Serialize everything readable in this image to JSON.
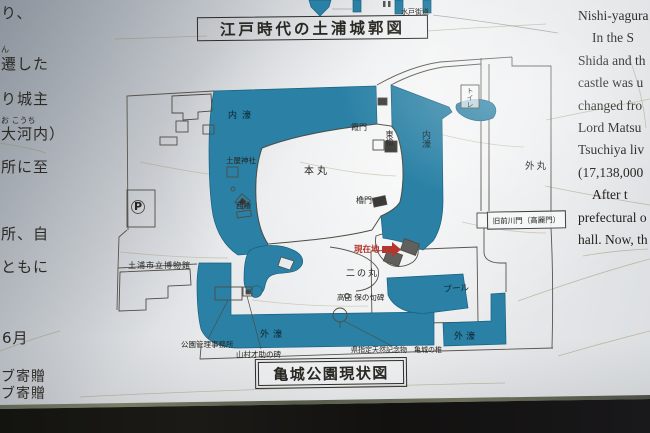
{
  "titles": {
    "edo_map": "江戸時代の土浦城郭図",
    "current_map": "亀城公園現状図"
  },
  "top_fragment": {
    "road_label": "水戸街道"
  },
  "left_text": {
    "lines": [
      {
        "text": "り、"
      },
      {
        "furigana": "ん",
        "text": "遷した"
      },
      {
        "text": "り城主"
      },
      {
        "furigana": "お こうち",
        "text": "大河内）"
      },
      {
        "text": "所に至"
      },
      {
        "text": "所、自"
      },
      {
        "text": "ともに"
      },
      {
        "text": "6月"
      },
      {
        "text": "ブ寄贈"
      },
      {
        "text": "ブ寄贈"
      }
    ]
  },
  "right_text": {
    "lines": [
      "Nishi-yagura",
      "In the S",
      "Shida and th",
      "castle was u",
      "changed fro",
      "Lord Matsu",
      "Tsuchiya liv",
      "(17,138,000",
      "After t",
      "prefectural o",
      "hall. Now, th"
    ]
  },
  "map": {
    "labels": {
      "inner_moat_top": "内濠",
      "inner_moat_right": "内濠",
      "outer_moat_left": "外濠",
      "outer_moat_right": "外濠",
      "honmaru": "本丸",
      "ninomaru": "二の丸",
      "sotomaru": "外丸",
      "tsuchiya_shrine": "土屋神社",
      "nishi_yagura": "西櫓",
      "higashi_yagura": "東櫓",
      "kasumi_gate": "霞門",
      "yagura_gate": "櫓門",
      "toilet": "トイレ",
      "old_maekawa_gate": "旧前川門（高麗門）",
      "current_location": "現在地",
      "takada_haiku_monument": "高田 保の句碑",
      "pool": "プール",
      "museum": "土浦市立博物館",
      "park_office": "公園管理事務所",
      "yamamura_monument": "山村才助の碑",
      "natural_monument": "県指定天然記念物　亀城の椎",
      "parking": "P"
    },
    "colors": {
      "moat": "#2a81a5",
      "line": "#57544c",
      "label": "#26241f",
      "marker_red": "#b5362e"
    }
  }
}
